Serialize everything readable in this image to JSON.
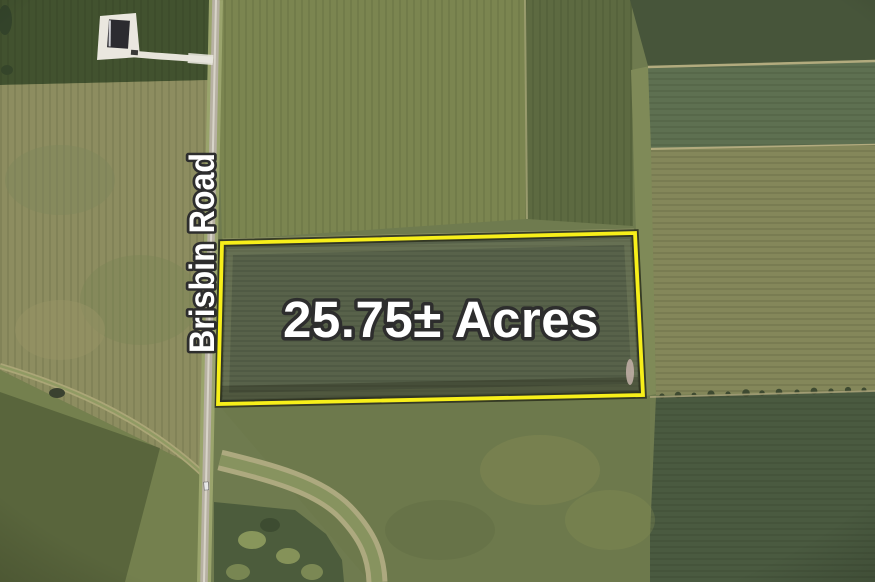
{
  "map": {
    "road": {
      "label": "Brisbin Road"
    },
    "parcel": {
      "label": "25.75± Acres",
      "outline_color": "#f7ef1a"
    },
    "labels": {
      "text_color": "#ffffff",
      "outline_color": "#2d2d2d"
    }
  }
}
